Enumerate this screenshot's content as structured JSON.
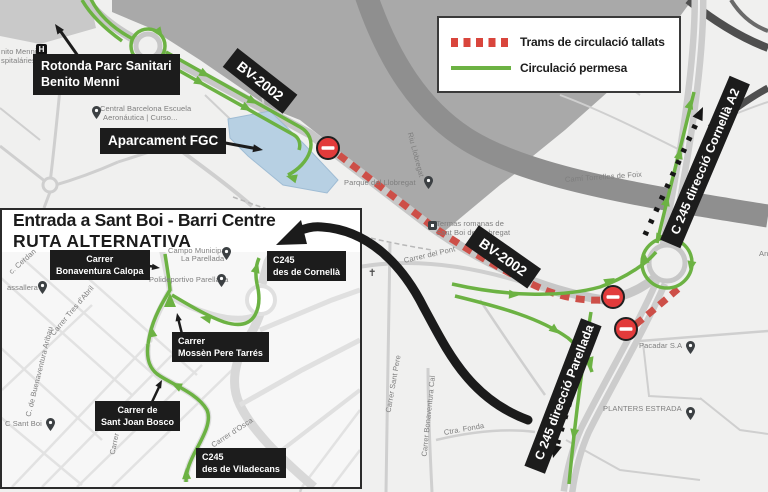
{
  "colors": {
    "closed_route": "#cd4f48",
    "legend_closed": "#d9453c",
    "allowed_route": "#6cb243",
    "water": "#b7d0e3",
    "label_bg": "#1c1c1c",
    "no_entry": "#e23b3b",
    "river": "#8f8f8f"
  },
  "legend": {
    "items": [
      {
        "label": "Trams de circulació tallats",
        "type": "closed"
      },
      {
        "label": "Circulació permesa",
        "type": "allowed"
      }
    ]
  },
  "main_map": {
    "callouts": {
      "rotonda_line1": "Rotonda Parc Sanitari",
      "rotonda_line2": "Benito Menni",
      "aparcament": "Aparcament FGC",
      "bv2002": "BV-2002",
      "c245_cornella": "C 245 direcció Cornellà A2",
      "c245_parellada": "C 245 direcció Parellada"
    },
    "street_labels": [
      {
        "t": "nito Menni...",
        "x": 1,
        "y": 47,
        "r": 0
      },
      {
        "t": "spitaláries",
        "x": 1,
        "y": 56,
        "r": 0
      },
      {
        "t": "Central Barcelona Escuela",
        "x": 100,
        "y": 104,
        "r": 0
      },
      {
        "t": "Aeronáutica | Curso...",
        "x": 103,
        "y": 113,
        "r": 0
      },
      {
        "t": "Parque del Llobregat",
        "x": 344,
        "y": 178,
        "r": 0
      },
      {
        "t": "Riu Llobregat",
        "x": 410,
        "y": 128,
        "r": 75
      },
      {
        "t": "Termas romanas de",
        "x": 436,
        "y": 219,
        "r": 0
      },
      {
        "t": "Sant Boi de Llobregat",
        "x": 436,
        "y": 228,
        "r": 0
      },
      {
        "t": "Camí Torrelles de Foix",
        "x": 565,
        "y": 175,
        "r": -4
      },
      {
        "t": "Carrer del Pont",
        "x": 404,
        "y": 256,
        "r": -13
      },
      {
        "t": "Pacadar S.A",
        "x": 639,
        "y": 341,
        "r": 0
      },
      {
        "t": "PLANTERS ESTRADA",
        "x": 603,
        "y": 404,
        "r": 0
      },
      {
        "t": "Carrer Sant Pere",
        "x": 388,
        "y": 408,
        "r": -80
      },
      {
        "t": "Carrer Bonaventura Cal",
        "x": 424,
        "y": 452,
        "r": -84
      },
      {
        "t": "Ctra. Fonda",
        "x": 444,
        "y": 428,
        "r": -10
      },
      {
        "t": "An",
        "x": 759,
        "y": 249,
        "r": 0
      }
    ]
  },
  "inset": {
    "title_line1": "Entrada a Sant Boi - Barri Centre",
    "title_line2": "RUTA ALTERNATIVA",
    "callouts": {
      "calopa_line1": "Carrer",
      "calopa_line2": "Bonaventura Calopa",
      "cornella_line1": "C245",
      "cornella_line2": "des de Cornellà",
      "tarres_line1": "Carrer",
      "tarres_line2": "Mossèn Pere Tarrés",
      "bosco_line1": "Carrer de",
      "bosco_line2": "Sant Joan Bosco",
      "viladecans_line1": "C245",
      "viladecans_line2": "des de Viladecans"
    },
    "street_labels": [
      {
        "t": "Campo Municipal",
        "x": 168,
        "y": 246,
        "r": 0
      },
      {
        "t": "La Parellada",
        "x": 181,
        "y": 254,
        "r": 0
      },
      {
        "t": "Polideportivo Parellada",
        "x": 149,
        "y": 275,
        "r": 0
      },
      {
        "t": "assallera",
        "x": 7,
        "y": 283,
        "r": 0
      },
      {
        "t": "c. Cerdan",
        "x": 10,
        "y": 268,
        "r": -42
      },
      {
        "t": "Carrer Tres d'Abril",
        "x": 52,
        "y": 330,
        "r": -50
      },
      {
        "t": "C. de Buenaventura Aribau",
        "x": 28,
        "y": 412,
        "r": -76
      },
      {
        "t": "C Sant Boi",
        "x": 5,
        "y": 419,
        "r": 0
      },
      {
        "t": "Carrer Mn",
        "x": 112,
        "y": 450,
        "r": -78
      },
      {
        "t": "Carrer d'Osca",
        "x": 212,
        "y": 441,
        "r": -33
      }
    ]
  },
  "pins": [
    {
      "x": 92,
      "y": 106,
      "k": "pin"
    },
    {
      "x": 424,
      "y": 176,
      "k": "pin"
    },
    {
      "x": 428,
      "y": 221,
      "k": "sq"
    },
    {
      "x": 686,
      "y": 341,
      "k": "pin"
    },
    {
      "x": 686,
      "y": 407,
      "k": "pin"
    },
    {
      "x": 368,
      "y": 268,
      "k": "church"
    },
    {
      "x": 36,
      "y": 44,
      "k": "hosp"
    },
    {
      "x": 222,
      "y": 247,
      "k": "pin"
    },
    {
      "x": 217,
      "y": 274,
      "k": "pin"
    },
    {
      "x": 38,
      "y": 281,
      "k": "pin"
    },
    {
      "x": 46,
      "y": 418,
      "k": "pin"
    }
  ]
}
